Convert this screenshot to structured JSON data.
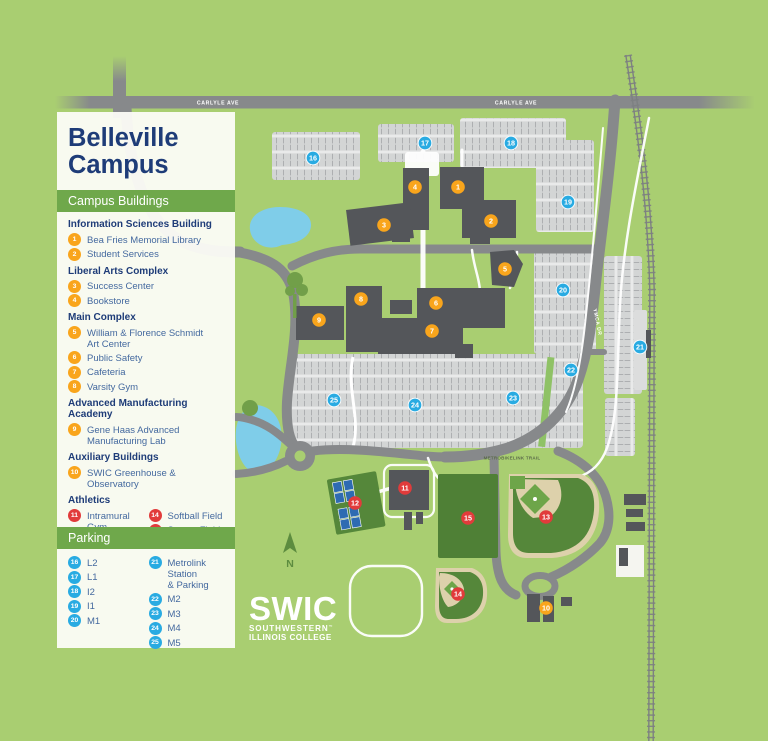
{
  "title": {
    "line1": "Belleville",
    "line2": "Campus"
  },
  "legend": {
    "buildings_header": "Campus Buildings",
    "parking_header": "Parking",
    "sections": [
      {
        "heading": "Information Sciences Building",
        "color": "yellow",
        "items": [
          {
            "n": "1",
            "label": "Bea Fries Memorial Library"
          },
          {
            "n": "2",
            "label": "Student Services"
          }
        ]
      },
      {
        "heading": "Liberal Arts Complex",
        "color": "yellow",
        "items": [
          {
            "n": "3",
            "label": "Success Center"
          },
          {
            "n": "4",
            "label": "Bookstore"
          }
        ]
      },
      {
        "heading": "Main Complex",
        "color": "yellow",
        "items": [
          {
            "n": "5",
            "label": "William & Florence Schmidt\nArt Center"
          },
          {
            "n": "6",
            "label": "Public Safety"
          },
          {
            "n": "7",
            "label": "Cafeteria"
          },
          {
            "n": "8",
            "label": "Varsity Gym"
          }
        ]
      },
      {
        "heading": "Advanced Manufacturing Academy",
        "color": "yellow",
        "items": [
          {
            "n": "9",
            "label": "Gene Haas Advanced\nManufacturing Lab"
          }
        ]
      },
      {
        "heading": "Auxiliary Buildings",
        "color": "yellow",
        "items": [
          {
            "n": "10",
            "label": "SWIC Greenhouse & Observatory"
          }
        ]
      },
      {
        "heading": "Athletics",
        "color": "red",
        "columns": [
          [
            {
              "n": "11",
              "label": "Intramural Gym"
            },
            {
              "n": "12",
              "label": "Tennis Courts"
            },
            {
              "n": "13",
              "label": "Baseball Field"
            }
          ],
          [
            {
              "n": "14",
              "label": "Softball Field"
            },
            {
              "n": "15",
              "label": "Soccer Field"
            }
          ]
        ]
      }
    ],
    "parking_columns": [
      [
        {
          "n": "16",
          "label": "L2"
        },
        {
          "n": "17",
          "label": "L1"
        },
        {
          "n": "18",
          "label": "I2"
        },
        {
          "n": "19",
          "label": "I1"
        },
        {
          "n": "20",
          "label": "M1"
        }
      ],
      [
        {
          "n": "21",
          "label": "Metrolink Station\n& Parking"
        },
        {
          "n": "22",
          "label": "M2"
        },
        {
          "n": "23",
          "label": "M3"
        },
        {
          "n": "24",
          "label": "M4"
        },
        {
          "n": "25",
          "label": "M5"
        }
      ]
    ]
  },
  "map": {
    "labels": {
      "carlyle_west": "CARLYLE AVE",
      "carlyle_east": "CARLYLE AVE",
      "ymca": "YMCA DR",
      "trail": "METROBIKELINK TRAIL",
      "north": "N"
    },
    "logo": {
      "word": "SWIC",
      "line2": "SOUTHWESTERN",
      "tm": "™",
      "line3": "ILLINOIS COLLEGE"
    },
    "markers": [
      {
        "n": "1",
        "x": 458,
        "y": 187,
        "c": "yellow"
      },
      {
        "n": "2",
        "x": 491,
        "y": 221,
        "c": "yellow"
      },
      {
        "n": "3",
        "x": 384,
        "y": 225,
        "c": "yellow"
      },
      {
        "n": "4",
        "x": 415,
        "y": 187,
        "c": "yellow"
      },
      {
        "n": "5",
        "x": 505,
        "y": 269,
        "c": "yellow"
      },
      {
        "n": "6",
        "x": 436,
        "y": 303,
        "c": "yellow"
      },
      {
        "n": "7",
        "x": 432,
        "y": 331,
        "c": "yellow"
      },
      {
        "n": "8",
        "x": 361,
        "y": 299,
        "c": "yellow"
      },
      {
        "n": "9",
        "x": 319,
        "y": 320,
        "c": "yellow"
      },
      {
        "n": "10",
        "x": 546,
        "y": 608,
        "c": "yellow"
      },
      {
        "n": "11",
        "x": 405,
        "y": 488,
        "c": "red"
      },
      {
        "n": "12",
        "x": 355,
        "y": 503,
        "c": "red"
      },
      {
        "n": "13",
        "x": 546,
        "y": 517,
        "c": "red"
      },
      {
        "n": "14",
        "x": 458,
        "y": 594,
        "c": "red"
      },
      {
        "n": "15",
        "x": 468,
        "y": 518,
        "c": "red"
      },
      {
        "n": "16",
        "x": 313,
        "y": 158,
        "c": "blue"
      },
      {
        "n": "17",
        "x": 425,
        "y": 143,
        "c": "blue"
      },
      {
        "n": "18",
        "x": 511,
        "y": 143,
        "c": "blue"
      },
      {
        "n": "19",
        "x": 568,
        "y": 202,
        "c": "blue"
      },
      {
        "n": "20",
        "x": 563,
        "y": 290,
        "c": "blue"
      },
      {
        "n": "21",
        "x": 640,
        "y": 347,
        "c": "blue"
      },
      {
        "n": "22",
        "x": 571,
        "y": 370,
        "c": "blue"
      },
      {
        "n": "23",
        "x": 513,
        "y": 398,
        "c": "blue"
      },
      {
        "n": "24",
        "x": 415,
        "y": 405,
        "c": "blue"
      },
      {
        "n": "25",
        "x": 334,
        "y": 400,
        "c": "blue"
      }
    ]
  },
  "colors": {
    "background_green": "#a9ce71",
    "road_gray": "#87898b",
    "parking_gray": "#d3d5d5",
    "building_gray": "#54565a",
    "field_green": "#55873a",
    "water_blue": "#7fcde9",
    "navy": "#1e3c78",
    "item_blue": "#44699f",
    "header_green": "#6fa84b",
    "marker_yellow": "#f9a51c",
    "marker_red": "#e13b3b",
    "marker_blue": "#29abe2"
  }
}
